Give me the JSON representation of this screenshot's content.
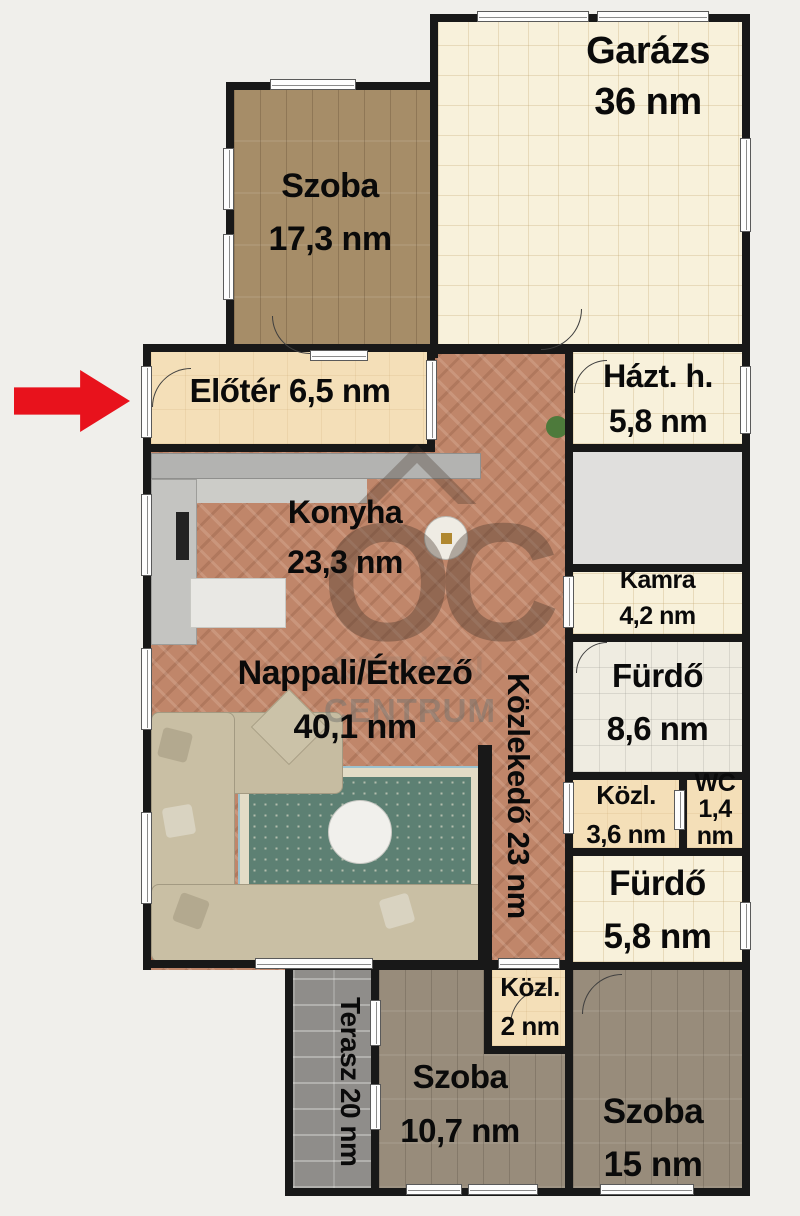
{
  "rooms": {
    "szoba_17": {
      "name": "Szoba",
      "area": "17,3 nm"
    },
    "garazs": {
      "name": "Garázs",
      "area": "36 nm"
    },
    "eloter": {
      "label": "Előtér 6,5 nm"
    },
    "hazt_h": {
      "name": "Házt. h.",
      "area": "5,8 nm"
    },
    "konyha": {
      "name": "Konyha",
      "area": "23,3 nm"
    },
    "kamra": {
      "name": "Kamra",
      "area": "4,2 nm"
    },
    "nappali": {
      "name": "Nappali/Étkező",
      "area": "40,1 nm"
    },
    "kozlekedo": {
      "label": "Közlekedő 23 nm"
    },
    "furdo_86": {
      "name": "Fürdő",
      "area": "8,6 nm"
    },
    "kozl_36": {
      "name": "Közl.",
      "area": "3,6 nm"
    },
    "wc": {
      "name": "WC",
      "area": "1,4 nm"
    },
    "furdo_58": {
      "name": "Fürdő",
      "area": "5,8 nm"
    },
    "kozl_2": {
      "name": "Közl.",
      "area": "2 nm"
    },
    "terasz": {
      "label": "Terasz 20 nm"
    },
    "szoba_107": {
      "name": "Szoba",
      "area": "10,7 nm"
    },
    "szoba_15": {
      "name": "Szoba",
      "area": "15 nm"
    }
  },
  "watermark": {
    "monogram": "OC",
    "brand_line1": "OTTHON",
    "brand_line2": "CENTRUM"
  },
  "annotations": {
    "entrance_arrow_color": "#e8121c",
    "wall_color": "#181818",
    "background_color": "#f0efeb"
  }
}
